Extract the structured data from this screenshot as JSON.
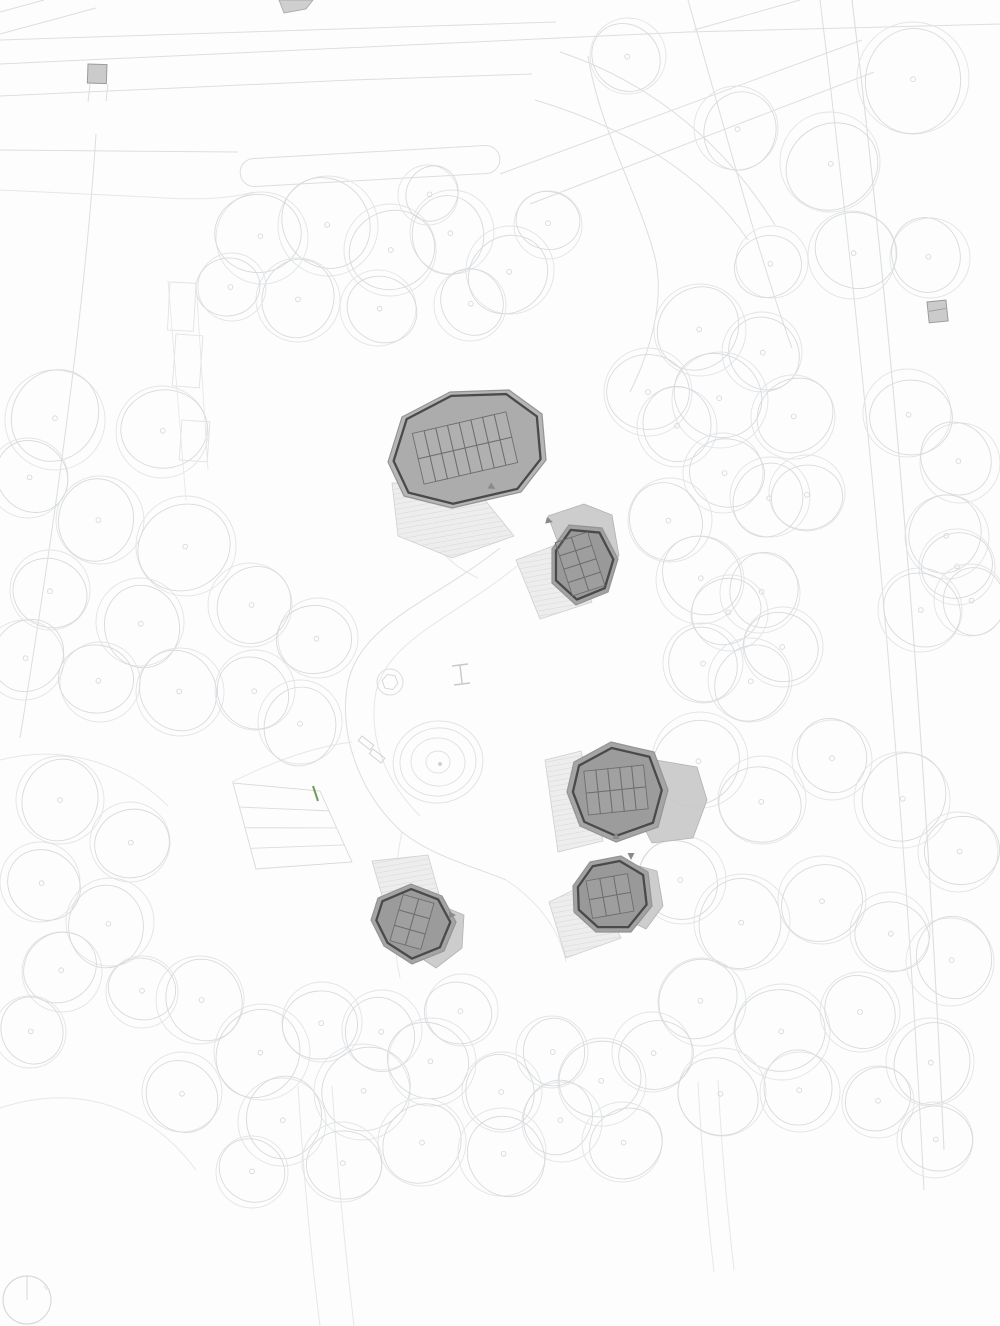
{
  "drawing": {
    "kind": "architectural-site-plan",
    "canvas": {
      "w": 1000,
      "h": 1326
    },
    "colors": {
      "bg": "#fdfdfd",
      "tree_outer": "#e2e4e6",
      "tree_inner": "#d7dadd",
      "tree_dot": "#d2d5d8",
      "road": "#dcdedf",
      "road_faint": "#e6e7e8",
      "pavilion_fill_large": "#b6b6b6",
      "pavilion_fill_small": "#a3a3a3",
      "pavilion_edge": "#949494",
      "pavilion_ring": "#4a4a4a",
      "canopy_fill": "#c9c9c9",
      "canopy_edge": "#b2b2b2",
      "terrace_fill": "#ededed",
      "terrace_hatch": "#d3d3d3",
      "terrace_edge": "#cfcfcf",
      "grid_line": "#6e6e6e",
      "arrow": "#8a8a8a",
      "green_mark": "#6f9e54",
      "square_fill": "#cbcbcb",
      "square_edge": "#9b9b9b"
    },
    "trees": [
      [
        262,
        238,
        46
      ],
      [
        328,
        226,
        50
      ],
      [
        298,
        300,
        42
      ],
      [
        390,
        250,
        46
      ],
      [
        378,
        308,
        38
      ],
      [
        452,
        232,
        42
      ],
      [
        510,
        270,
        44
      ],
      [
        548,
        225,
        34
      ],
      [
        470,
        305,
        36
      ],
      [
        428,
        195,
        30
      ],
      [
        232,
        287,
        34
      ],
      [
        628,
        56,
        38
      ],
      [
        913,
        78,
        56
      ],
      [
        830,
        162,
        50
      ],
      [
        852,
        255,
        44
      ],
      [
        930,
        258,
        40
      ],
      [
        700,
        330,
        46
      ],
      [
        648,
        392,
        44
      ],
      [
        762,
        352,
        40
      ],
      [
        736,
        128,
        42
      ],
      [
        772,
        262,
        36
      ],
      [
        720,
        400,
        48
      ],
      [
        677,
        427,
        40
      ],
      [
        793,
        417,
        42
      ],
      [
        723,
        473,
        40
      ],
      [
        670,
        520,
        42
      ],
      [
        770,
        497,
        40
      ],
      [
        807,
        493,
        38
      ],
      [
        700,
        580,
        44
      ],
      [
        760,
        593,
        40
      ],
      [
        730,
        613,
        38
      ],
      [
        783,
        647,
        40
      ],
      [
        703,
        663,
        40
      ],
      [
        750,
        680,
        42
      ],
      [
        907,
        413,
        44
      ],
      [
        960,
        463,
        40
      ],
      [
        947,
        537,
        42
      ],
      [
        957,
        567,
        38
      ],
      [
        920,
        610,
        42
      ],
      [
        970,
        600,
        36
      ],
      [
        700,
        760,
        48
      ],
      [
        762,
        800,
        44
      ],
      [
        832,
        760,
        40
      ],
      [
        902,
        800,
        48
      ],
      [
        958,
        852,
        40
      ],
      [
        682,
        880,
        44
      ],
      [
        742,
        922,
        48
      ],
      [
        822,
        900,
        44
      ],
      [
        890,
        932,
        40
      ],
      [
        950,
        962,
        44
      ],
      [
        702,
        1002,
        44
      ],
      [
        782,
        1032,
        48
      ],
      [
        860,
        1012,
        40
      ],
      [
        930,
        1062,
        44
      ],
      [
        652,
        1052,
        40
      ],
      [
        722,
        1092,
        44
      ],
      [
        800,
        1092,
        40
      ],
      [
        878,
        1102,
        36
      ],
      [
        935,
        1140,
        38
      ],
      [
        200,
        1000,
        44
      ],
      [
        262,
        1052,
        48
      ],
      [
        322,
        1022,
        40
      ],
      [
        182,
        1092,
        40
      ],
      [
        282,
        1122,
        44
      ],
      [
        362,
        1092,
        48
      ],
      [
        432,
        1062,
        44
      ],
      [
        502,
        1092,
        40
      ],
      [
        422,
        1142,
        44
      ],
      [
        342,
        1162,
        40
      ],
      [
        502,
        1152,
        44
      ],
      [
        562,
        1122,
        40
      ],
      [
        602,
        1082,
        44
      ],
      [
        252,
        1172,
        36
      ],
      [
        552,
        1052,
        36
      ],
      [
        622,
        1142,
        40
      ],
      [
        462,
        1010,
        36
      ],
      [
        382,
        1030,
        40
      ],
      [
        55,
        420,
        50
      ],
      [
        162,
        432,
        46
      ],
      [
        28,
        478,
        40
      ],
      [
        100,
        520,
        44
      ],
      [
        186,
        546,
        50
      ],
      [
        50,
        590,
        40
      ],
      [
        140,
        622,
        44
      ],
      [
        24,
        660,
        40
      ],
      [
        100,
        682,
        40
      ],
      [
        180,
        692,
        44
      ],
      [
        60,
        800,
        44
      ],
      [
        130,
        842,
        40
      ],
      [
        40,
        882,
        40
      ],
      [
        110,
        922,
        44
      ],
      [
        62,
        972,
        40
      ],
      [
        142,
        992,
        36
      ],
      [
        30,
        1032,
        36
      ],
      [
        250,
        605,
        42
      ],
      [
        318,
        638,
        40
      ],
      [
        255,
        690,
        40
      ],
      [
        300,
        722,
        42
      ]
    ],
    "roads": [
      {
        "d": "M0,40 L556,22",
        "w": 1
      },
      {
        "d": "M0,64 L688,32 L1000,24",
        "w": 1
      },
      {
        "d": "M0,96 L352,80 L532,74",
        "w": 1
      },
      {
        "d": "M0,150 L238,152",
        "w": 1
      },
      {
        "d": "M500,174 L862,40",
        "w": 1
      },
      {
        "d": "M530,204 L874,72",
        "w": 1
      },
      {
        "d": "M852,0 C898,380 926,760 944,1150",
        "w": 1.1
      },
      {
        "d": "M820,0 C868,390 904,790 924,1190",
        "w": 1
      },
      {
        "d": "M688,0 C722,120 760,260 792,348",
        "w": 1
      },
      {
        "d": "M588,56 C600,132 642,200 656,262 C664,304 650,352 630,392",
        "w": 1
      },
      {
        "d": "M96,134 C84,320 52,540 20,738",
        "w": 1
      },
      {
        "d": "M0,12 L44,0",
        "w": 1
      },
      {
        "d": "M0,34 L96,8",
        "w": 1
      },
      {
        "d": "M90,84 L88,102",
        "w": 1
      },
      {
        "d": "M108,84 L106,101",
        "w": 1
      },
      {
        "d": "M535,100 C630,128 706,178 748,240",
        "w": 1
      },
      {
        "d": "M560,52 C655,84 726,146 775,225",
        "w": 1
      },
      {
        "d": "M694,30 L800,0",
        "w": 1
      },
      {
        "d": "M0,190 L148,197 C204,201 232,198 254,192",
        "w": 1,
        "faint": true
      },
      {
        "d": "M500,548 C432,602 362,622 348,682 C338,732 358,792 402,832 C432,856 472,866 506,880",
        "w": 1
      },
      {
        "d": "M522,562 C458,616 388,638 376,692 C368,736 384,780 420,816",
        "w": 1,
        "faint": true
      },
      {
        "d": "M420,508 C430,545 450,565 478,578",
        "w": 1,
        "faint": true
      },
      {
        "d": "M402,832 C392,880 390,930 400,978",
        "w": 1,
        "faint": true
      },
      {
        "d": "M506,880 C540,902 560,932 566,962",
        "w": 1,
        "faint": true
      },
      {
        "d": "M232,782 C280,758 320,746 352,742",
        "w": 1,
        "faint": true
      },
      {
        "d": "M698,1082 C702,1160 708,1220 714,1272",
        "w": 1,
        "faint": true
      },
      {
        "d": "M718,1080 C722,1158 728,1218 734,1270",
        "w": 1,
        "faint": true
      },
      {
        "d": "M298,1086 C304,1180 312,1264 320,1326",
        "w": 1,
        "faint": true
      },
      {
        "d": "M332,1086 C338,1180 346,1258 354,1326",
        "w": 1,
        "faint": true
      },
      {
        "d": "M0,760 C70,742 130,768 168,806",
        "w": 1,
        "faint": true
      },
      {
        "d": "M0,1108 C80,1082 150,1108 196,1170",
        "w": 1,
        "faint": true
      }
    ],
    "capsule_path": {
      "x": 240,
      "y": 152,
      "w": 260,
      "h": 28,
      "rx": 14,
      "rot": -3.2,
      "cx": 370,
      "cy": 166
    },
    "boardwalk": {
      "rects": [
        [
          170,
          282,
          26,
          48,
          3
        ],
        [
          176,
          334,
          27,
          52,
          4
        ],
        [
          182,
          420,
          28,
          40,
          4
        ]
      ],
      "guides": [
        {
          "d": "M168,280 L186,500"
        },
        {
          "d": "M196,282 L208,470"
        }
      ]
    },
    "steps_terrace": {
      "outline": [
        [
          233,
          783
        ],
        [
          320,
          791
        ],
        [
          352,
          862
        ],
        [
          256,
          869
        ]
      ],
      "band_fractions": [
        0.28,
        0.52,
        0.76
      ],
      "green_mark": {
        "d": "M313,786 L318,801"
      }
    },
    "playground": {
      "equip_circle": {
        "cx": 390,
        "cy": 682,
        "r": 13,
        "inner_r": 8
      },
      "mound_rings": [
        [
          438,
          762,
          45,
          41,
          -8
        ],
        [
          438,
          762,
          38,
          34,
          -8
        ],
        [
          438,
          762,
          27,
          24,
          5
        ],
        [
          438,
          762,
          12,
          11,
          0
        ]
      ],
      "mound_dot": {
        "cx": 440,
        "cy": 764,
        "r": 2
      },
      "h_mark": {
        "d": "M452,666 L468,664 M460,665 L462,683 M454,685 L470,683"
      },
      "benches": [
        [
          362,
          736,
          15,
          6,
          38
        ],
        [
          373,
          749,
          15,
          6,
          38
        ]
      ]
    },
    "buildings": [
      {
        "name": "pavilion-1",
        "terrace": [
          [
            392,
            483
          ],
          [
            468,
            479
          ],
          [
            514,
            536
          ],
          [
            452,
            558
          ],
          [
            398,
            536
          ]
        ],
        "body": [
          [
            388,
            462
          ],
          [
            402,
            417
          ],
          [
            450,
            392
          ],
          [
            509,
            390
          ],
          [
            542,
            414
          ],
          [
            546,
            460
          ],
          [
            521,
            492
          ],
          [
            452,
            508
          ],
          [
            404,
            496
          ]
        ],
        "fill": "#b6b6b6",
        "ring_scale": 0.93,
        "grid": {
          "cx": 465,
          "cy": 448,
          "cols": 8,
          "rows": 2,
          "cw": 12,
          "ch": 26,
          "rot": -13
        },
        "arrows": [
          {
            "x": 492,
            "y": 487,
            "rot": 120
          }
        ]
      },
      {
        "name": "pavilion-2",
        "canopy": [
          [
            548,
            516
          ],
          [
            584,
            504
          ],
          [
            612,
            515
          ],
          [
            619,
            556
          ],
          [
            601,
            574
          ],
          [
            560,
            548
          ]
        ],
        "terrace": [
          [
            516,
            560
          ],
          [
            566,
            541
          ],
          [
            592,
            602
          ],
          [
            540,
            619
          ]
        ],
        "body": [
          [
            552,
            549
          ],
          [
            569,
            525
          ],
          [
            602,
            528
          ],
          [
            618,
            559
          ],
          [
            608,
            592
          ],
          [
            576,
            605
          ],
          [
            552,
            583
          ]
        ],
        "fill": "#a2a2a2",
        "ring_scale": 0.87,
        "grid": {
          "cx": 580,
          "cy": 564,
          "cols": 2,
          "rows": 4,
          "cw": 17,
          "ch": 14,
          "rot": -18
        },
        "arrows": [
          {
            "x": 549,
            "y": 521,
            "rot": 105
          }
        ]
      },
      {
        "name": "pavilion-3",
        "canopy": [
          [
            638,
            757
          ],
          [
            697,
            767
          ],
          [
            707,
            800
          ],
          [
            693,
            838
          ],
          [
            652,
            843
          ],
          [
            629,
            799
          ]
        ],
        "terrace": [
          [
            545,
            760
          ],
          [
            581,
            751
          ],
          [
            603,
            841
          ],
          [
            558,
            852
          ]
        ],
        "body": [
          [
            574,
            762
          ],
          [
            611,
            742
          ],
          [
            654,
            752
          ],
          [
            668,
            790
          ],
          [
            658,
            827
          ],
          [
            616,
            842
          ],
          [
            580,
            826
          ],
          [
            567,
            792
          ]
        ],
        "fill": "#a5a5a5",
        "ring_scale": 0.88,
        "grid": {
          "cx": 616,
          "cy": 790,
          "cols": 5,
          "rows": 2,
          "cw": 12,
          "ch": 22,
          "rot": -6
        },
        "arrows": [
          {
            "x": 616,
            "y": 836,
            "rot": 0
          },
          {
            "x": 631,
            "y": 856,
            "rot": 180
          }
        ]
      },
      {
        "name": "pavilion-4",
        "canopy": [
          [
            624,
            862
          ],
          [
            657,
            871
          ],
          [
            663,
            906
          ],
          [
            646,
            929
          ],
          [
            620,
            916
          ]
        ],
        "terrace": [
          [
            549,
            902
          ],
          [
            592,
            881
          ],
          [
            621,
            938
          ],
          [
            566,
            958
          ]
        ],
        "body": [
          [
            573,
            886
          ],
          [
            590,
            862
          ],
          [
            621,
            856
          ],
          [
            648,
            872
          ],
          [
            652,
            906
          ],
          [
            631,
            932
          ],
          [
            596,
            932
          ],
          [
            574,
            912
          ]
        ],
        "fill": "#a2a2a2",
        "ring_scale": 0.87,
        "grid": {
          "cx": 610,
          "cy": 896,
          "cols": 3,
          "rows": 2,
          "cw": 14,
          "ch": 19,
          "rot": -10
        },
        "arrows": []
      },
      {
        "name": "pavilion-5",
        "terrace": [
          [
            372,
            861
          ],
          [
            428,
            855
          ],
          [
            439,
            894
          ],
          [
            385,
            906
          ]
        ],
        "canopy": [
          [
            430,
            901
          ],
          [
            464,
            915
          ],
          [
            462,
            948
          ],
          [
            436,
            968
          ],
          [
            412,
            952
          ]
        ],
        "body": [
          [
            378,
            898
          ],
          [
            411,
            884
          ],
          [
            442,
            896
          ],
          [
            456,
            922
          ],
          [
            444,
            951
          ],
          [
            412,
            964
          ],
          [
            384,
            946
          ],
          [
            371,
            920
          ]
        ],
        "fill": "#a4a4a4",
        "ring_scale": 0.87,
        "grid": {
          "cx": 412,
          "cy": 922,
          "cols": 2,
          "rows": 3,
          "cw": 16,
          "ch": 16,
          "rot": 16
        },
        "arrows": [
          {
            "x": 452,
            "y": 915,
            "rot": 90
          }
        ]
      }
    ],
    "small_structures": [
      {
        "name": "utility-square-1",
        "type": "rect",
        "x": 88,
        "y": 64,
        "w": 19,
        "h": 19,
        "rot": 2
      },
      {
        "name": "utility-square-2",
        "type": "rect",
        "x": 927,
        "y": 302,
        "w": 19,
        "h": 21,
        "rot": -6,
        "divider": true
      },
      {
        "name": "roof-fragment-top",
        "type": "poly",
        "pts": [
          [
            279,
            0
          ],
          [
            313,
            0
          ],
          [
            306,
            9
          ],
          [
            284,
            13
          ]
        ]
      }
    ],
    "north_indicator": {
      "cx": 27,
      "cy": 1300,
      "r": 24,
      "needle": "M27,1276 L27,1300",
      "tick": "M44,1286 L47,1290"
    }
  }
}
